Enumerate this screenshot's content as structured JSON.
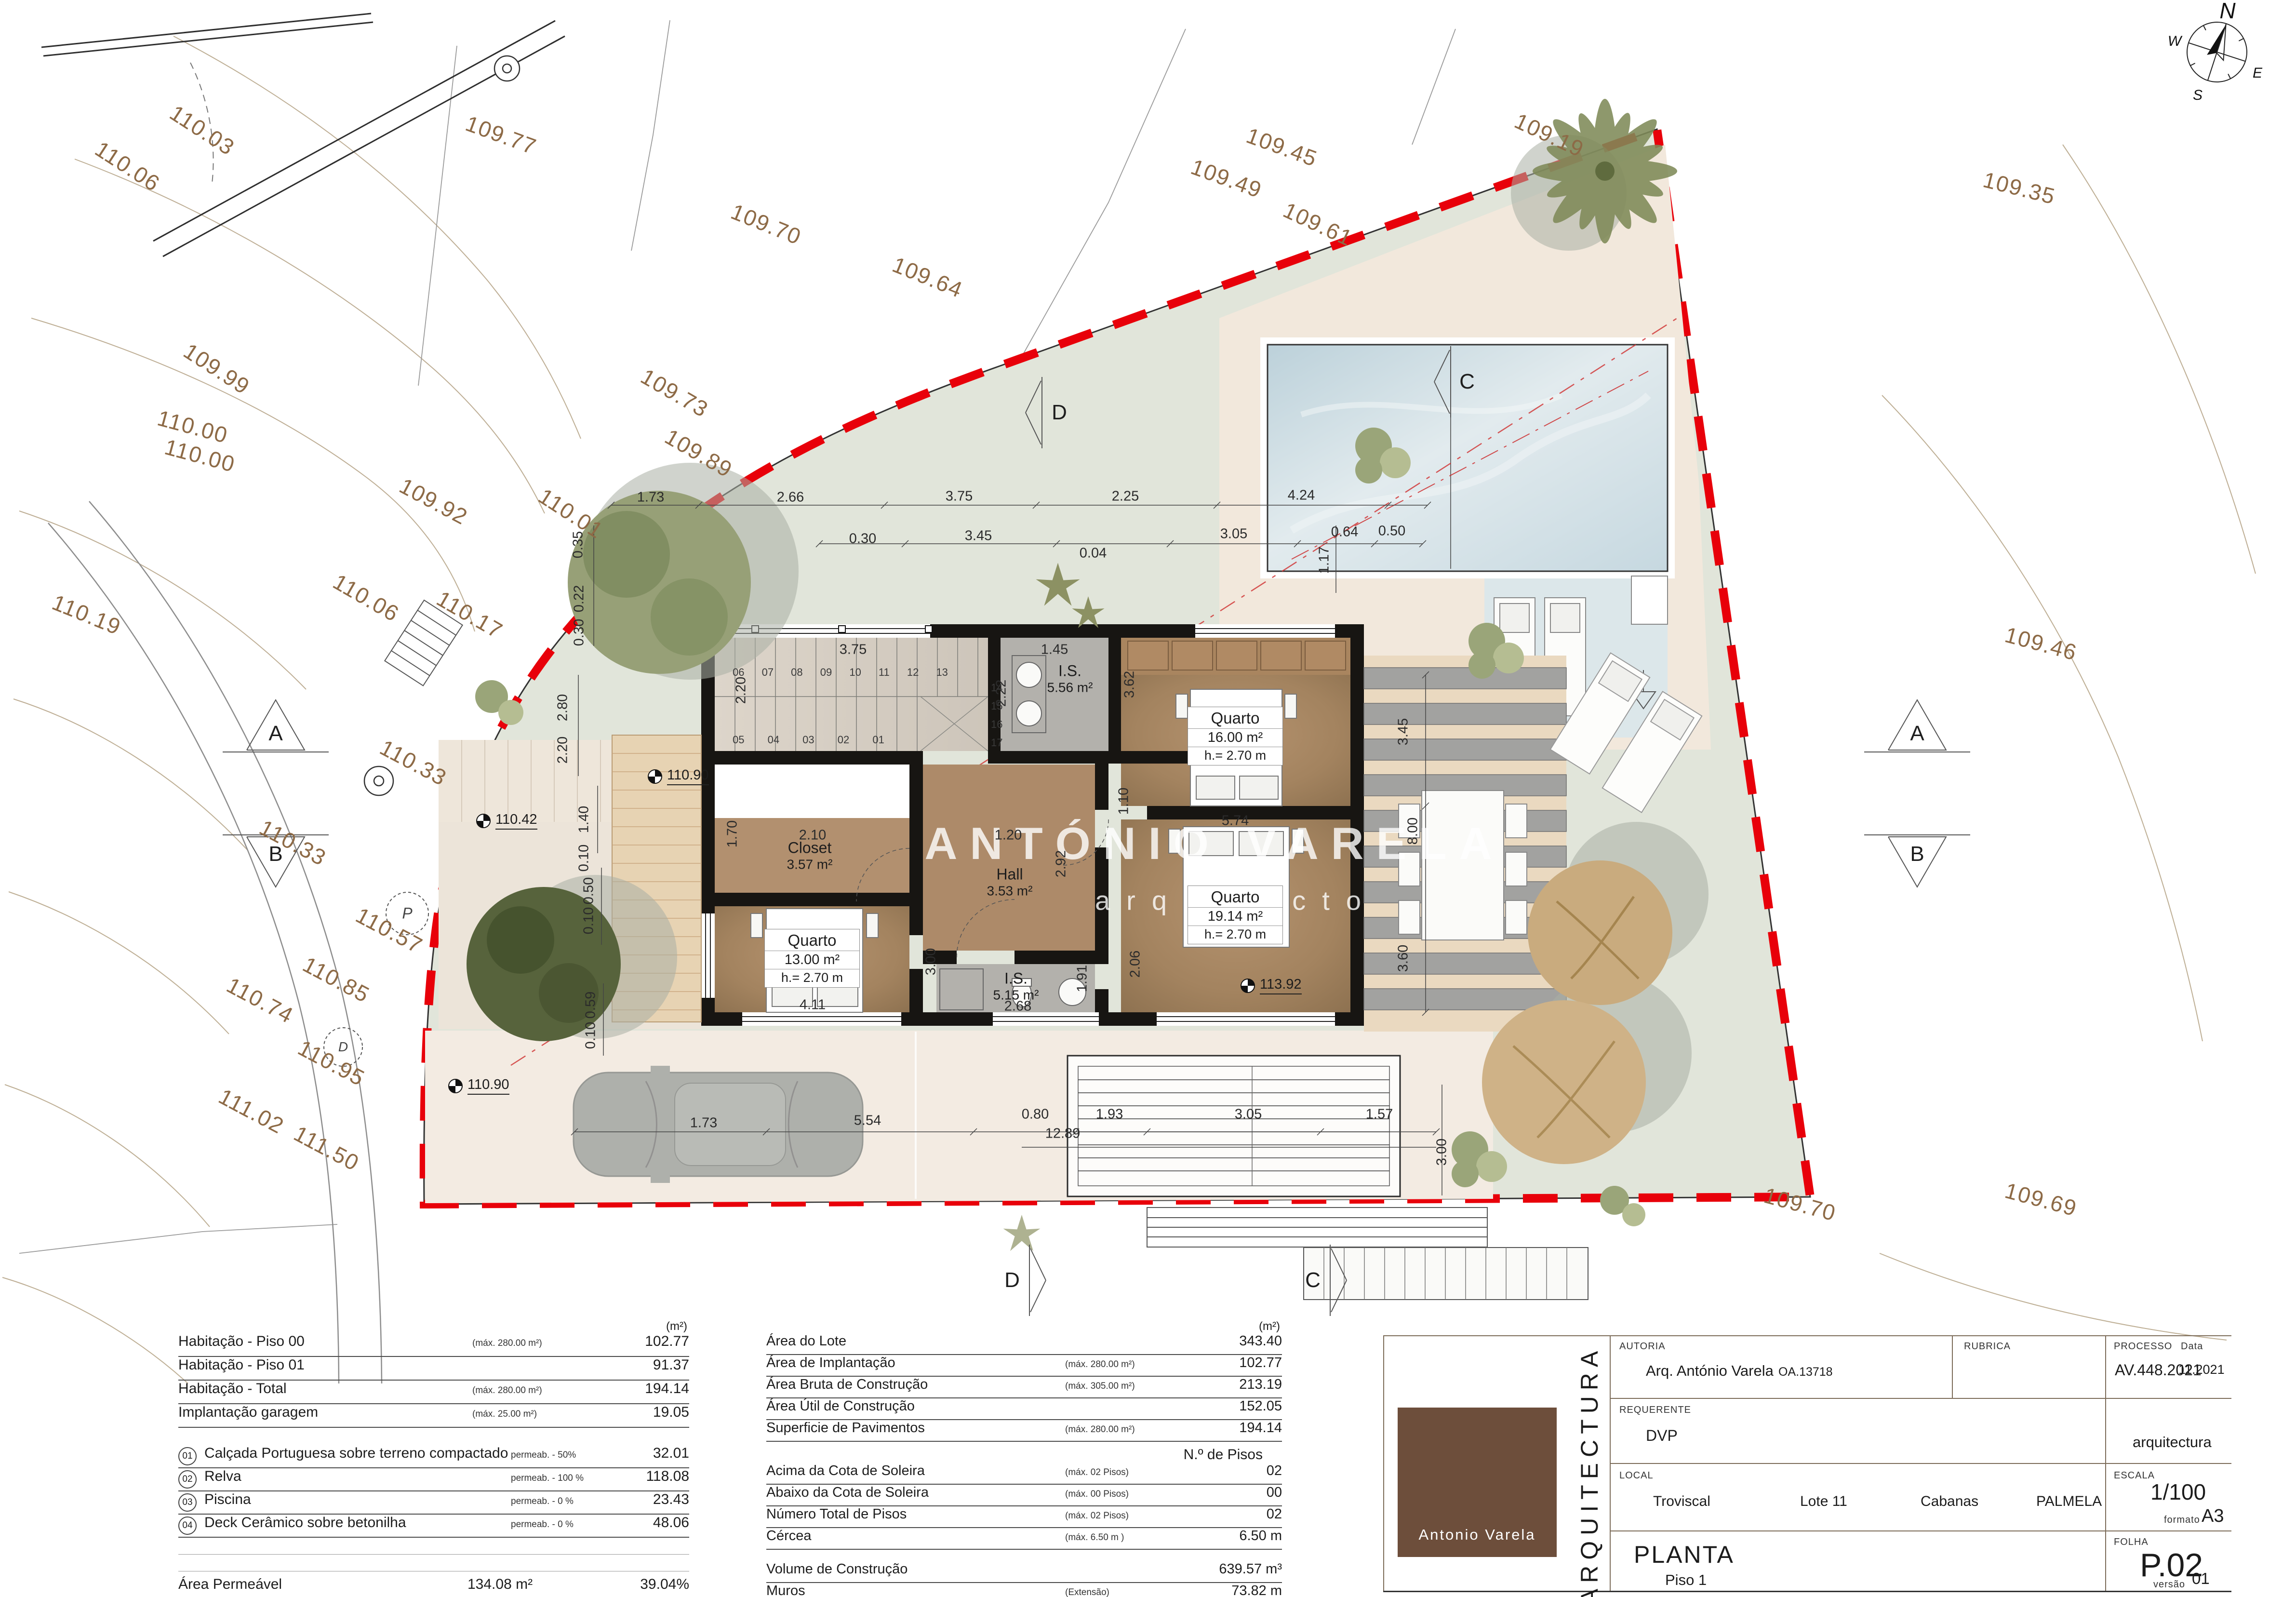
{
  "colors": {
    "boundary_red": "#e8000a",
    "elevation_brown": "#8d6a46",
    "wall_black": "#171512",
    "room_brown": "#a9855f",
    "pool_blue": "#c9dae2",
    "grass_green": "#e1e5da",
    "logo_brown": "#6d4e3b"
  },
  "plan": {
    "watermark": {
      "line1": "ANTÓNIO VARELA",
      "line2": "arquitecto"
    },
    "compass": {
      "n": "N",
      "e": "E",
      "s": "S",
      "w": "W"
    },
    "markers": {
      "a": "A",
      "b": "B",
      "c": "C",
      "d": "D",
      "p": "P"
    },
    "stairs": {
      "top": "06 07 08 09 10 11 12 13",
      "bottom": "05 04 03 02 01",
      "column": "14\n15\n16\n17"
    },
    "rooms": [
      {
        "name": "Quarto",
        "area": "16.00 m²",
        "height": "h.= 2.70 m"
      },
      {
        "name": "Quarto",
        "area": "19.14 m²",
        "height": "h.= 2.70 m"
      },
      {
        "name": "Quarto",
        "area": "13.00 m²",
        "height": "h.= 2.70 m"
      },
      {
        "name": "Closet",
        "area": "3.57 m²"
      },
      {
        "name": "Hall",
        "area": "3.53 m²"
      },
      {
        "name": "I.S.",
        "area": "5.56 m²"
      },
      {
        "name": "I.S.",
        "area": "5.15 m²"
      }
    ],
    "levels": [
      {
        "t": "110.42"
      },
      {
        "t": "110.90"
      },
      {
        "t": "110.90"
      },
      {
        "t": "113.92"
      }
    ],
    "elevations": [
      {
        "t": "110.03"
      },
      {
        "t": "110.06"
      },
      {
        "t": "109.77"
      },
      {
        "t": "109.70"
      },
      {
        "t": "109.64"
      },
      {
        "t": "109.49"
      },
      {
        "t": "109.45"
      },
      {
        "t": "109.61"
      },
      {
        "t": "109.19"
      },
      {
        "t": "109.35"
      },
      {
        "t": "109.73"
      },
      {
        "t": "109.89"
      },
      {
        "t": "109.99"
      },
      {
        "t": "110.00"
      },
      {
        "t": "110.00"
      },
      {
        "t": "109.92"
      },
      {
        "t": "110.01"
      },
      {
        "t": "110.06"
      },
      {
        "t": "110.17"
      },
      {
        "t": "110.19"
      },
      {
        "t": "110.33"
      },
      {
        "t": "110.33"
      },
      {
        "t": "110.57"
      },
      {
        "t": "110.74"
      },
      {
        "t": "110.85"
      },
      {
        "t": "110.95"
      },
      {
        "t": "111.02"
      },
      {
        "t": "111.50"
      },
      {
        "t": "109.46"
      },
      {
        "t": "109.70"
      },
      {
        "t": "109.69"
      }
    ],
    "dims": [
      {
        "t": "1.73"
      },
      {
        "t": "2.66"
      },
      {
        "t": "3.75"
      },
      {
        "t": "2.25"
      },
      {
        "t": "4.24"
      },
      {
        "t": "0.30"
      },
      {
        "t": "3.45"
      },
      {
        "t": "0.04"
      },
      {
        "t": "3.05"
      },
      {
        "t": "0.64"
      },
      {
        "t": "0.50"
      },
      {
        "t": "1.17"
      },
      {
        "t": "0.35"
      },
      {
        "t": "0.22"
      },
      {
        "t": "0.30"
      },
      {
        "t": "2.80"
      },
      {
        "t": "2.20"
      },
      {
        "t": "1.40"
      },
      {
        "t": "0.10"
      },
      {
        "t": "0.50"
      },
      {
        "t": "0.10"
      },
      {
        "t": "0.59"
      },
      {
        "t": "0.10"
      },
      {
        "t": "3.75"
      },
      {
        "t": "2.20"
      },
      {
        "t": "1.45"
      },
      {
        "t": "3.62"
      },
      {
        "t": "2.22"
      },
      {
        "t": "2.10"
      },
      {
        "t": "1.70"
      },
      {
        "t": "1.20"
      },
      {
        "t": "2.92"
      },
      {
        "t": "1.10"
      },
      {
        "t": "3.45"
      },
      {
        "t": "5.74"
      },
      {
        "t": "8.00"
      },
      {
        "t": "3.60"
      },
      {
        "t": "3.00"
      },
      {
        "t": "4.11"
      },
      {
        "t": "1.91"
      },
      {
        "t": "2.68"
      },
      {
        "t": "2.06"
      },
      {
        "t": "1.73"
      },
      {
        "t": "5.54"
      },
      {
        "t": "0.80"
      },
      {
        "t": "1.93"
      },
      {
        "t": "3.05"
      },
      {
        "t": "1.57"
      },
      {
        "t": "12.89"
      },
      {
        "t": "3.00"
      }
    ]
  },
  "tables": {
    "left": {
      "unit_header": "(m²)",
      "rows": [
        {
          "label": "Habitação - Piso 00",
          "note": "(máx. 280.00 m²)",
          "value": "102.77"
        },
        {
          "label": "Habitação - Piso 01",
          "note": "",
          "value": "91.37"
        },
        {
          "label": "Habitação - Total",
          "note": "(máx. 280.00 m²)",
          "value": "194.14"
        },
        {
          "label": "Implantação garagem",
          "note": "(máx. 25.00 m²)",
          "value": "19.05"
        }
      ],
      "materials": [
        {
          "num": "01",
          "label": "Calçada Portuguesa sobre terreno compactado",
          "note": "permeab. - 50%",
          "value": "32.01"
        },
        {
          "num": "02",
          "label": "Relva",
          "note": "permeab. - 100 %",
          "value": "118.08"
        },
        {
          "num": "03",
          "label": "Piscina",
          "note": "permeab. - 0 %",
          "value": "23.43"
        },
        {
          "num": "04",
          "label": "Deck Cerâmico sobre betonilha",
          "note": "permeab. - 0 %",
          "value": "48.06"
        }
      ],
      "totals": [
        {
          "label": "Área Permeável",
          "value": "134.08 m²",
          "pct": "39.04%"
        },
        {
          "label": "Área Impermeável",
          "value": "209.32 m²",
          "pct": "60.96%"
        }
      ]
    },
    "middle": {
      "unit_header": "(m²)",
      "rows": [
        {
          "label": "Área do Lote",
          "note": "",
          "value": "343.40"
        },
        {
          "label": "Área de Implantação",
          "note": "(máx. 280.00 m²)",
          "value": "102.77"
        },
        {
          "label": "Área Bruta de Construção",
          "note": "(máx. 305.00 m²)",
          "value": "213.19"
        },
        {
          "label": "Área Útil de Construção",
          "note": "",
          "value": "152.05"
        },
        {
          "label": "Superficie de Pavimentos",
          "note": "(máx. 280.00 m²)",
          "value": "194.14"
        }
      ],
      "pisos_header": "N.º  de Pisos",
      "pisos": [
        {
          "label": "Acima da Cota de Soleira",
          "note": "(máx. 02 Pisos)",
          "value": "02"
        },
        {
          "label": "Abaixo da Cota de Soleira",
          "note": "(máx. 00 Pisos)",
          "value": "00"
        },
        {
          "label": "Número Total de Pisos",
          "note": "(máx. 02 Pisos)",
          "value": "02"
        },
        {
          "label": "Cércea",
          "note": "(máx. 6.50 m )",
          "value": "6.50 m"
        }
      ],
      "extras": [
        {
          "label": "Volume de Construção",
          "note": "",
          "value": "639.57 m³"
        },
        {
          "label": "Muros",
          "note": "(Extensão)",
          "value": "73.82 m"
        },
        {
          "label": "Muros",
          "note": "(Altura)",
          "value": "0.80 m"
        }
      ]
    }
  },
  "title_block": {
    "logo_name": "Antonio Varela",
    "discipline": "ARQUITECTURA",
    "autoria_label": "AUTORIA",
    "autoria": "Arq. António Varela",
    "autoria_num": "OA.13718",
    "rubrica_label": "RUBRICA",
    "processo_label": "PROCESSO",
    "processo": "AV.448.2021",
    "data_label": "Data",
    "data": "11.2021",
    "requerente_label": "REQUERENTE",
    "requerente": "DVP",
    "dept": "arquitectura",
    "local_label": "LOCAL",
    "local_1": "Troviscal",
    "local_2": "Lote 11",
    "local_3": "Cabanas",
    "local_4": "PALMELA",
    "escala_label": "ESCALA",
    "escala": "1/100",
    "formato_label": "formato",
    "formato": "A3",
    "folha_label": "FOLHA",
    "folha": "P.02",
    "versao_label": "versão",
    "versao": "01",
    "sheet_title": "PLANTA",
    "sheet_subtitle": "Piso 1"
  }
}
